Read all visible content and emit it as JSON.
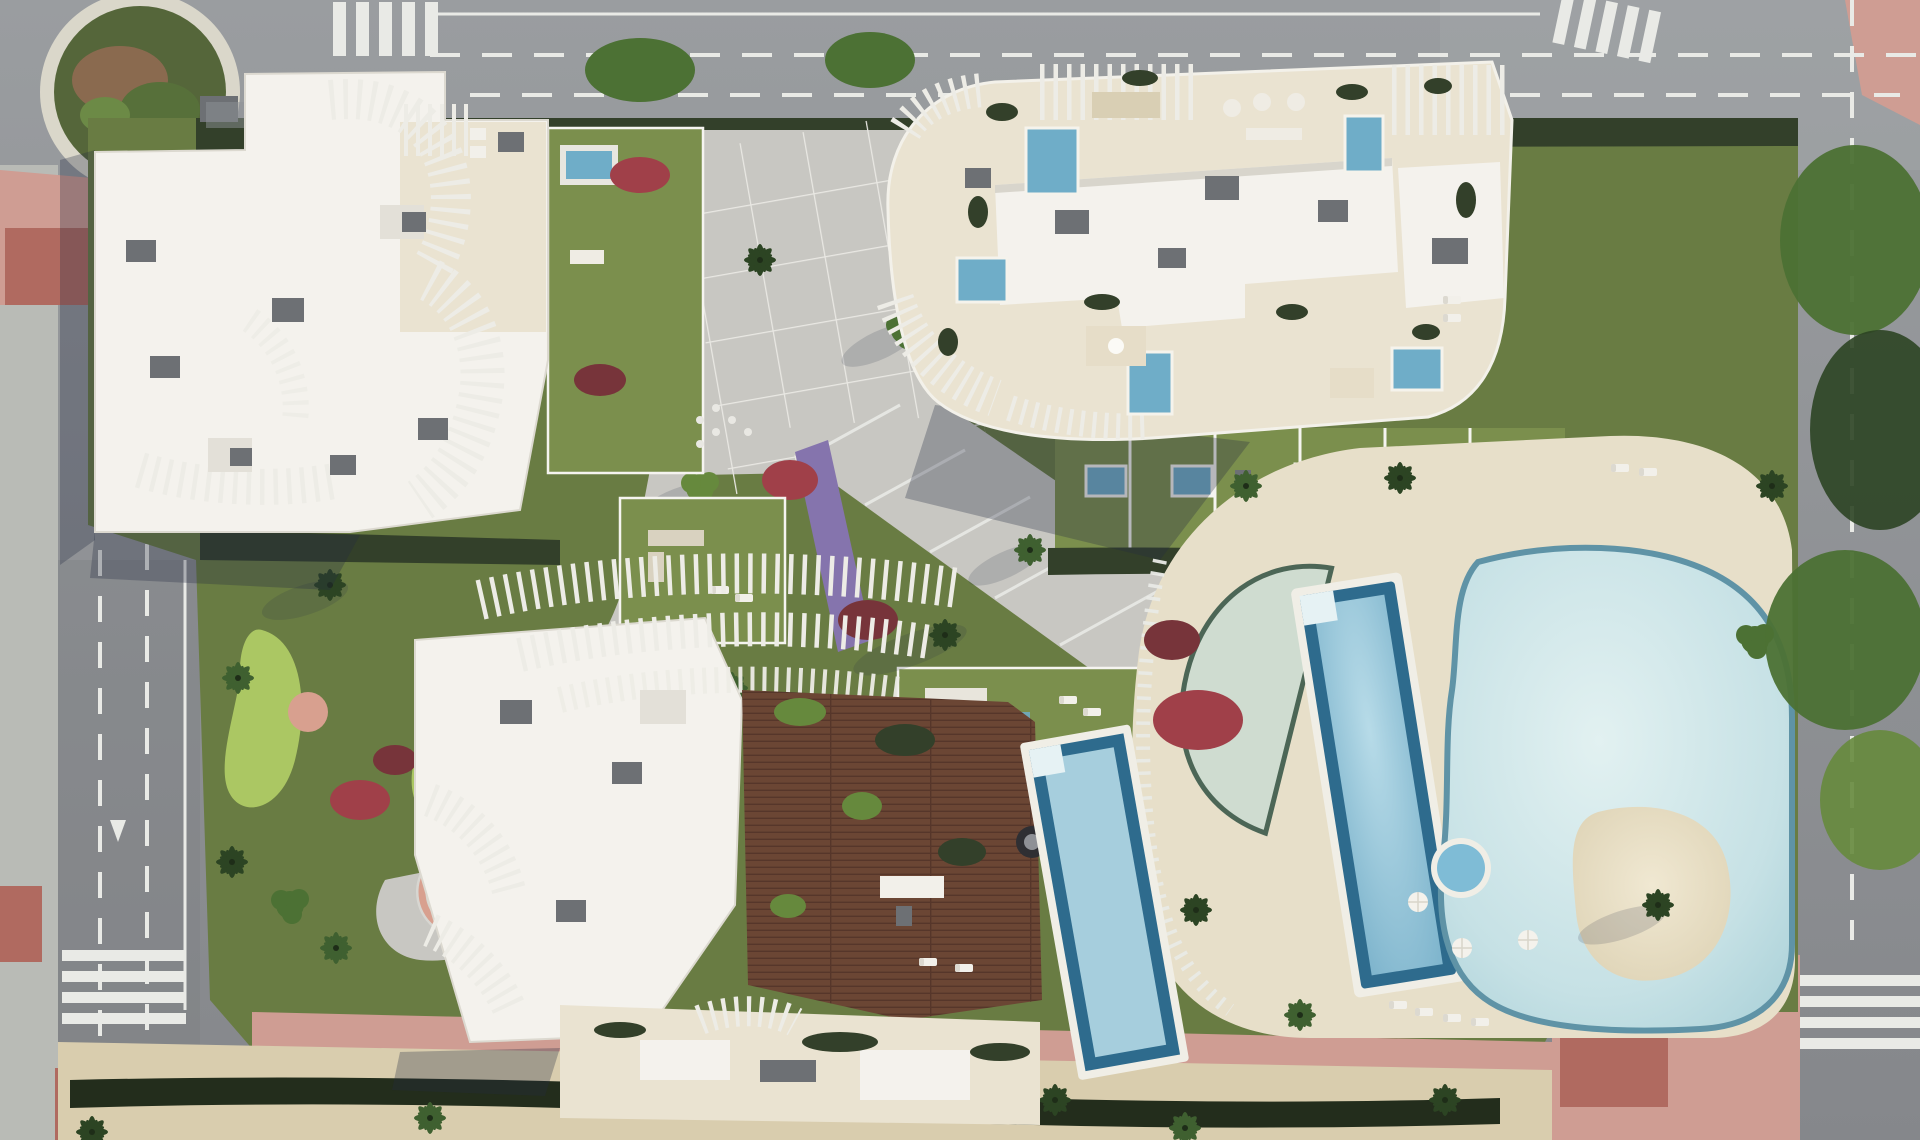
{
  "meta": {
    "kind": "aerial-architectural-render",
    "description": "Top-down aerial rendering of a residential complex: three white apartment buildings with sculptural louvered roofs and rooftop terraces, central paved plaza, landscaped gardens with red and purple flower beds, a large free-form lagoon pool with sand island, lap pool, crescent kids pool and jacuzzi on a cream deck, rooftop wooden deck with pool on the south building, putting green, perimeter roads with crosswalks, a roundabout at the north-west corner and a palm-lined sandy promenade along the south edge.",
    "canvas": {
      "width": 1920,
      "height": 1140
    }
  },
  "colors": {
    "asphalt": "#8f9194",
    "asphalt_light": "#a2a6a8",
    "asphalt_dark": "#7c7e82",
    "sidewalk": "#b9bbb6",
    "paving": "#c8c7c2",
    "paving_light": "#d7d6d1",
    "deck_cream": "#e7dfc9",
    "deck_cream_light": "#f0e9d6",
    "roof_white": "#f4f2ed",
    "roof_shadow": "#d8d5cc",
    "terrace_cream": "#eae3d1",
    "louver": "#edece6",
    "louver_gap": "#9aa09c",
    "box_gray": "#6d7074",
    "box_gray_light": "#8e9196",
    "lawn": "#697c43",
    "lawn_light": "#7b8f4d",
    "lawn_dark": "#55663a",
    "hedge": "#33402a",
    "hedge_dark": "#232d1c",
    "putting_green": "#abc763",
    "maroon": "#77343a",
    "red_flower": "#a04049",
    "purple_flower": "#8574ad",
    "sand": "#d9cdae",
    "island_sand": "#e7dec5",
    "pool_lagoon": "#c6e1e5",
    "pool_lagoon_light": "#e2f1f1",
    "pool_rim": "#5f93a6",
    "pool_lap": "#8fc3d8",
    "pool_border": "#2e6b8d",
    "pool_pale": "#cfdcd0",
    "pool_pale_rim": "#4c6656",
    "pool_plunge": "#6fadc8",
    "pool_roof": "#a6cedd",
    "wood": "#6b4634",
    "wood_dark": "#56362a",
    "pink_paving": "#cf9d93",
    "red_paving": "#b06a60",
    "white_line": "#e9eae6",
    "palm_dark": "#2c4423",
    "palm_mid": "#3f6030",
    "tree_green": "#4c7134",
    "tree_light": "#66893d",
    "water_jacuzzi": "#7fbcd6",
    "planter_pink": "#d8a08f",
    "shadow": "rgba(38,44,66,0.30)",
    "shadow_soft": "rgba(38,44,66,0.16)"
  },
  "scene": {
    "roads": [
      "top-road",
      "left-road-with-roundabout",
      "right-road-tree-covered",
      "south-promenade"
    ],
    "road_markings": [
      "dashed-lane-lines",
      "crosswalk-top",
      "crosswalk-left-upper",
      "crosswalk-left-lower",
      "crosswalk-bottom-left",
      "crosswalk-bottom-right",
      "turn-arrow"
    ],
    "buildings": [
      {
        "name": "north-west-building",
        "features": [
          "white-flat-roof",
          "curved-louver-screens",
          "rooftop-terrace-pergola",
          "hvac-boxes"
        ]
      },
      {
        "name": "north-east-building",
        "features": [
          "cream-roof-terraces",
          "plunge-pools",
          "outdoor-furniture",
          "pergola-slats",
          "ground-floor-garden-units-with-pools"
        ]
      },
      {
        "name": "south-building",
        "features": [
          "wavy-louver-pergolas",
          "rooftop-wooden-deck",
          "rooftop-pool",
          "cream-terraces"
        ]
      }
    ],
    "amenities": [
      "lagoon-pool-with-sand-island",
      "lap-pool",
      "crescent-pool",
      "jacuzzi",
      "pool-deck-with-umbrellas-and-loungers",
      "putting-green",
      "central-plaza",
      "garden-courts",
      "roundabout-planting-island",
      "round-tree-planter"
    ],
    "vegetation": [
      "palm-trees",
      "round-canopy-trees",
      "dark-hedges",
      "red-flower-beds",
      "purple-flower-path",
      "lawns"
    ]
  }
}
